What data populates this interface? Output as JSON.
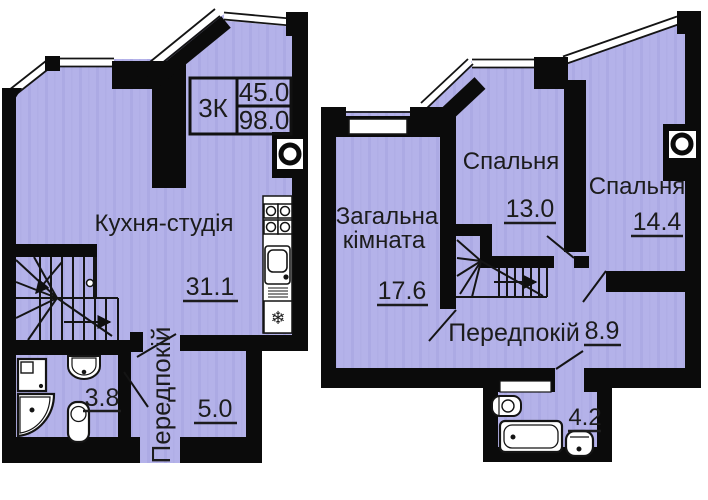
{
  "plan": {
    "title": "Duplex apartment floor plan, two levels",
    "info_box": {
      "type": "3К",
      "area_upper": "45.0",
      "area_total": "98.0"
    },
    "floor1": {
      "kitchen_label": "Кухня-студія",
      "kitchen_area": "31.1",
      "bathroom_area": "3.8",
      "hallway_label": "Передпокій",
      "storage_area": "5.0"
    },
    "floor2": {
      "living_label_line1": "Загальна",
      "living_label_line2": "кімната",
      "living_area": "17.6",
      "bedroom1_label": "Спальня",
      "bedroom1_area": "13.0",
      "bedroom2_label": "Спальня",
      "bedroom2_area": "14.4",
      "hallway_label": "Передпокій",
      "hallway_area": "8.9",
      "bathroom_area": "4.2"
    },
    "icons": {
      "fridge_symbol": "❄"
    },
    "colors": {
      "wall": "#0b0b0b",
      "floor_fill": "#b4b2e9",
      "floor_streak": "#acaae4",
      "text": "#1c1c1c"
    }
  }
}
